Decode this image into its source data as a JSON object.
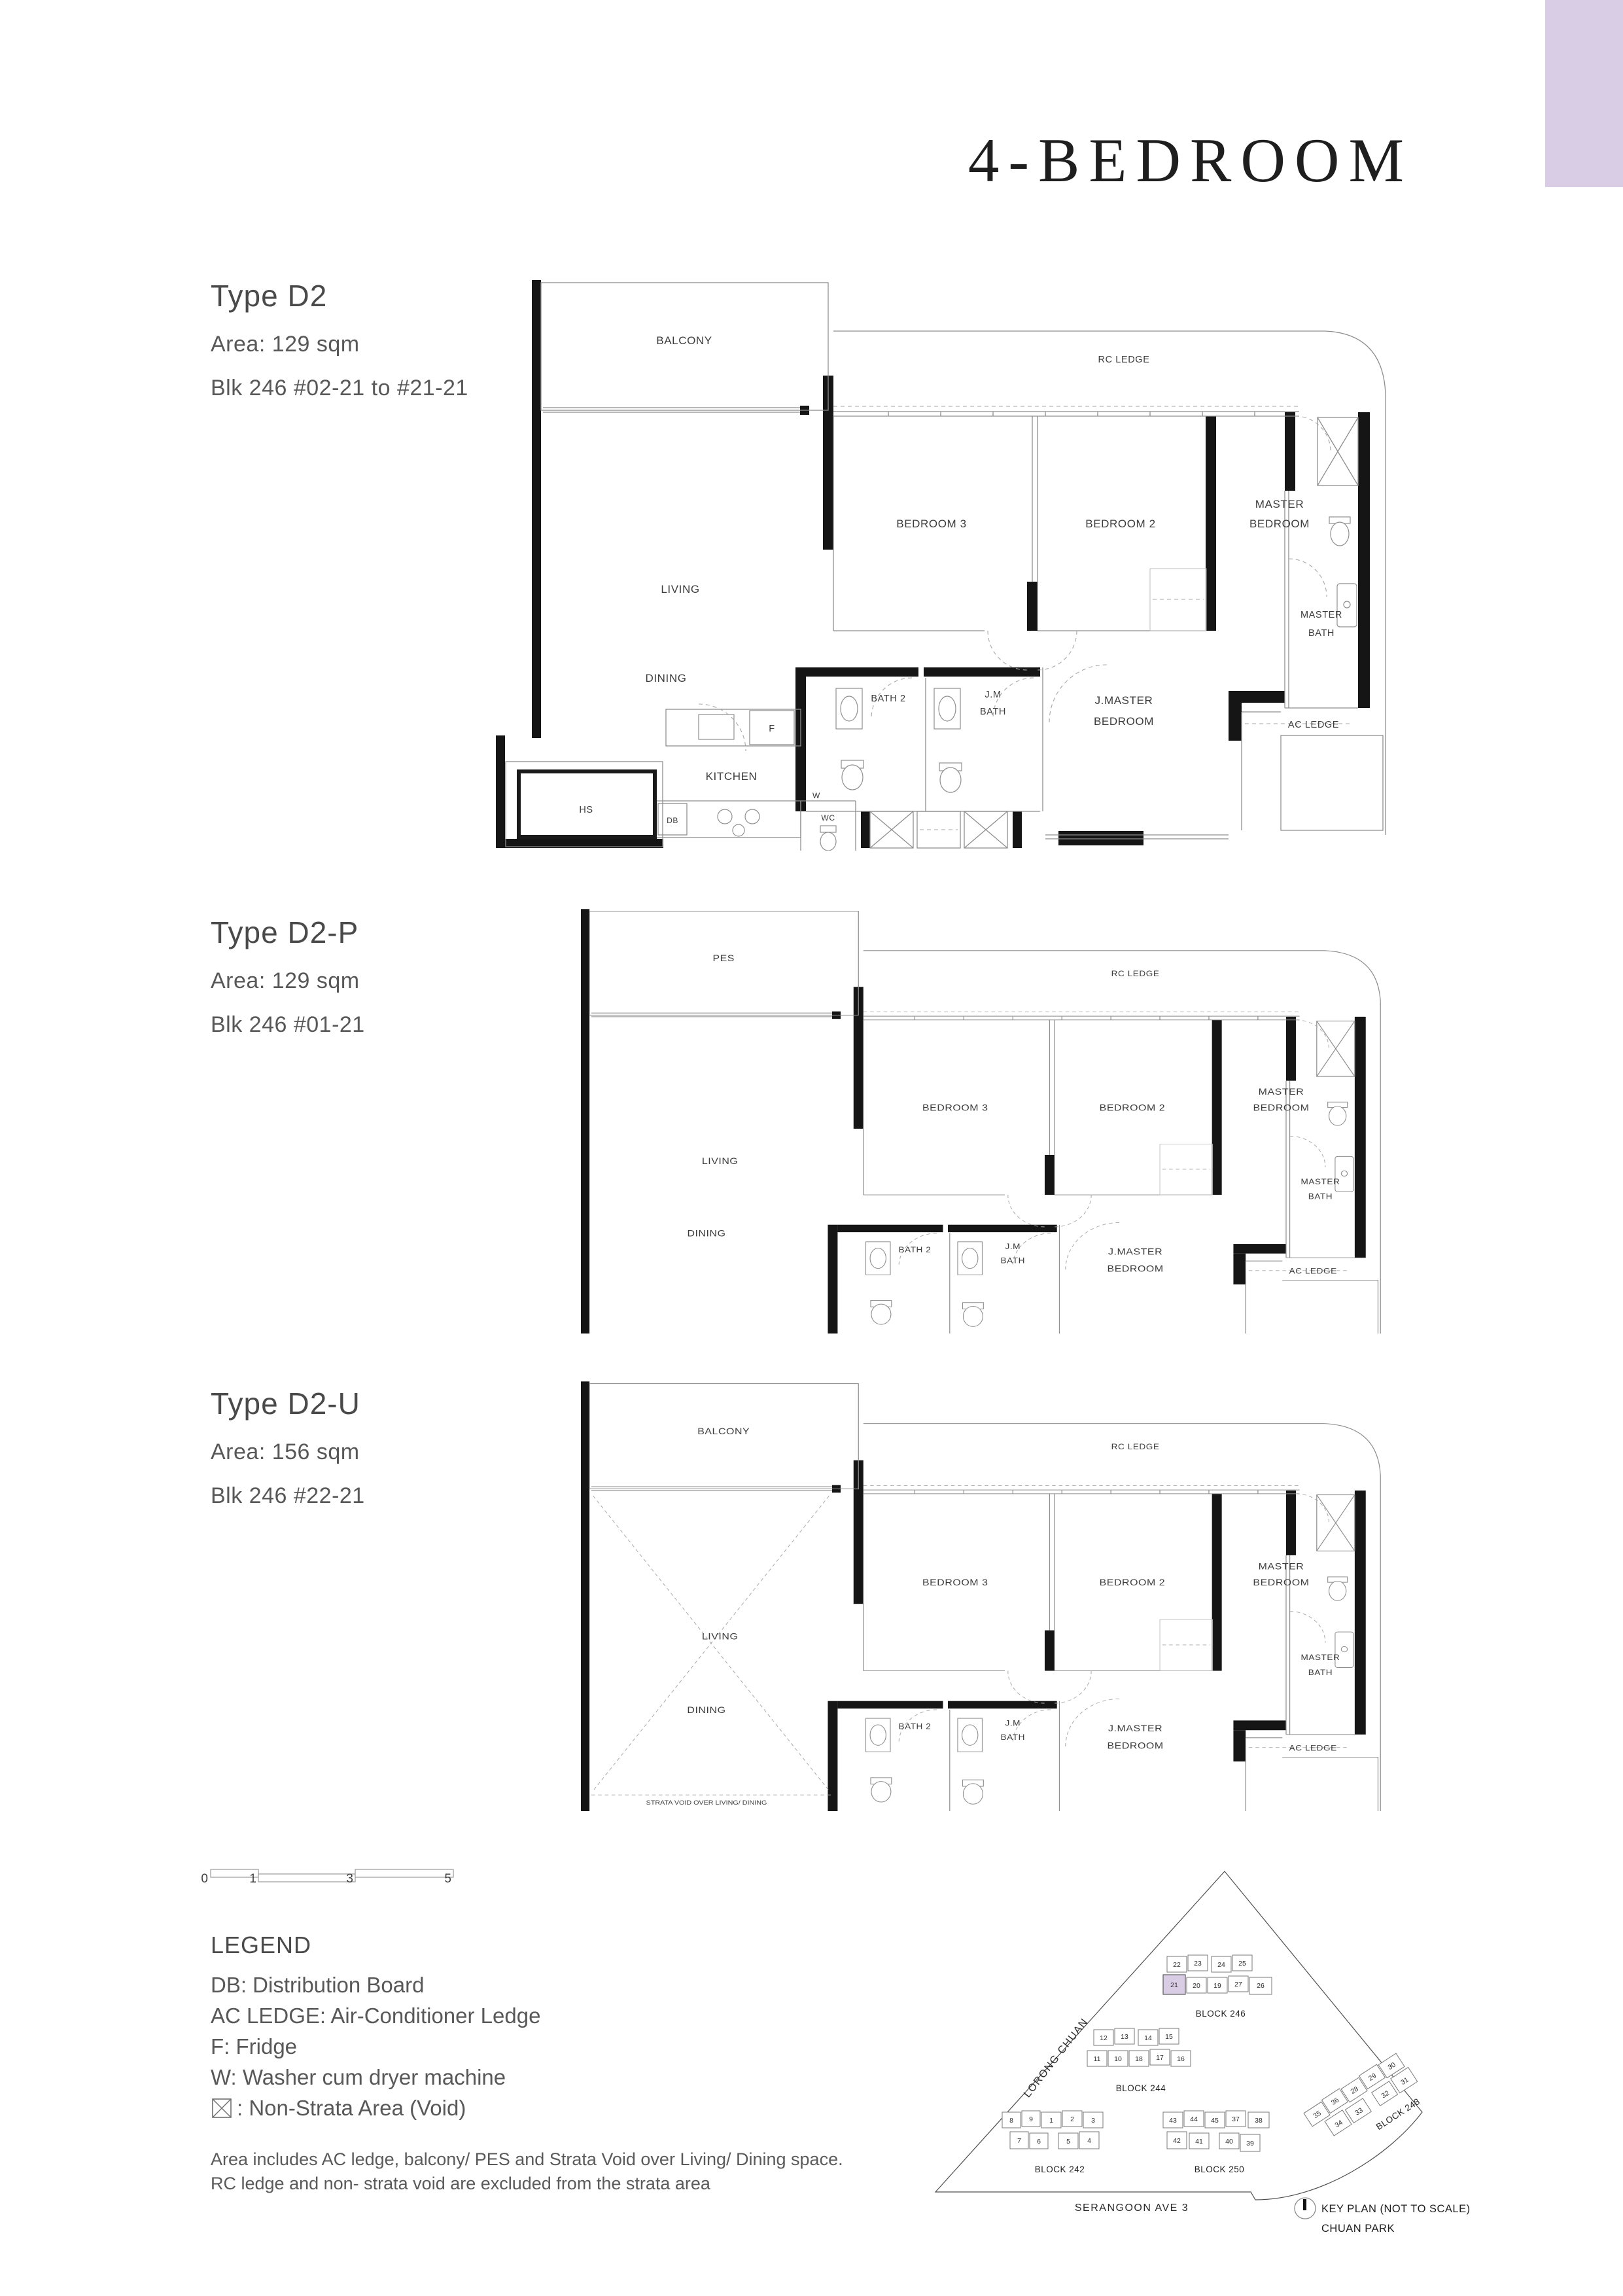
{
  "page": {
    "title": "4-BEDROOM",
    "accent_color": "#d9cde5"
  },
  "types": [
    {
      "name": "Type D2",
      "area": "Area: 129 sqm",
      "blk": "Blk 246  #02-21 to #21-21"
    },
    {
      "name": "Type D2-P",
      "area": "Area: 129 sqm",
      "blk": "Blk 246  #01-21"
    },
    {
      "name": "Type D2-U",
      "area": "Area: 156 sqm",
      "blk": "Blk 246  #22-21"
    }
  ],
  "rooms": {
    "balcony": "BALCONY",
    "pes": "PES",
    "rc_ledge": "RC LEDGE",
    "living": "LIVING",
    "dining": "DINING",
    "bedroom3": "BEDROOM 3",
    "bedroom2": "BEDROOM 2",
    "master1": "MASTER",
    "master2": "BEDROOM",
    "masterbath1": "MASTER",
    "masterbath2": "BATH",
    "bath2": "BATH 2",
    "jmbath1": "J.M",
    "jmbath2": "BATH",
    "jmaster1": "J.MASTER",
    "jmaster2": "BEDROOM",
    "ac_ledge": "AC LEDGE",
    "kitchen": "KITCHEN",
    "hs": "HS",
    "db": "DB",
    "f": "F",
    "w": "W",
    "wc": "WC",
    "strata_note": "STRATA VOID OVER LIVING/ DINING"
  },
  "scalebar": {
    "t0": "0",
    "t1": "1",
    "t3": "3",
    "t5": "5"
  },
  "legend": {
    "title": "LEGEND",
    "items": [
      "DB: Distribution Board",
      "AC LEDGE: Air-Conditioner Ledge",
      "F: Fridge",
      "W: Washer cum dryer machine"
    ],
    "void_item": ": Non-Strata Area (Void)"
  },
  "footnote": [
    "Area includes AC ledge, balcony/ PES and Strata Void over Living/ Dining space.",
    "RC ledge and non- strata void are excluded from the strata area"
  ],
  "keyplan": {
    "roads": {
      "lorong_chuan": "LORONG CHUAN",
      "serangoon": "SERANGOON AVE 3"
    },
    "caption1": "KEY PLAN (NOT TO SCALE)",
    "caption2": "CHUAN PARK",
    "highlight_unit": "21",
    "blocks": [
      {
        "label": "BLOCK 246",
        "row1": [
          "22",
          "23",
          "24",
          "25"
        ],
        "row2": [
          "21",
          "20",
          "19",
          "27",
          "26"
        ]
      },
      {
        "label": "BLOCK 244",
        "row1": [
          "12",
          "13",
          "14",
          "15"
        ],
        "row2": [
          "11",
          "10",
          "18",
          "17",
          "16"
        ]
      },
      {
        "label": "BLOCK 242",
        "row1": [
          "8",
          "9",
          "1",
          "2",
          "3"
        ],
        "row2": [
          "7",
          "6",
          "5",
          "4"
        ]
      },
      {
        "label": "BLOCK 250",
        "row1": [
          "43",
          "44",
          "45",
          "37",
          "38"
        ],
        "row2": [
          "42",
          "41",
          "40",
          "39"
        ]
      },
      {
        "label": "BLOCK 248",
        "row1": [
          "35",
          "36",
          "28",
          "29",
          "30"
        ],
        "row2": [
          "34",
          "33",
          "32",
          "31"
        ]
      }
    ]
  }
}
